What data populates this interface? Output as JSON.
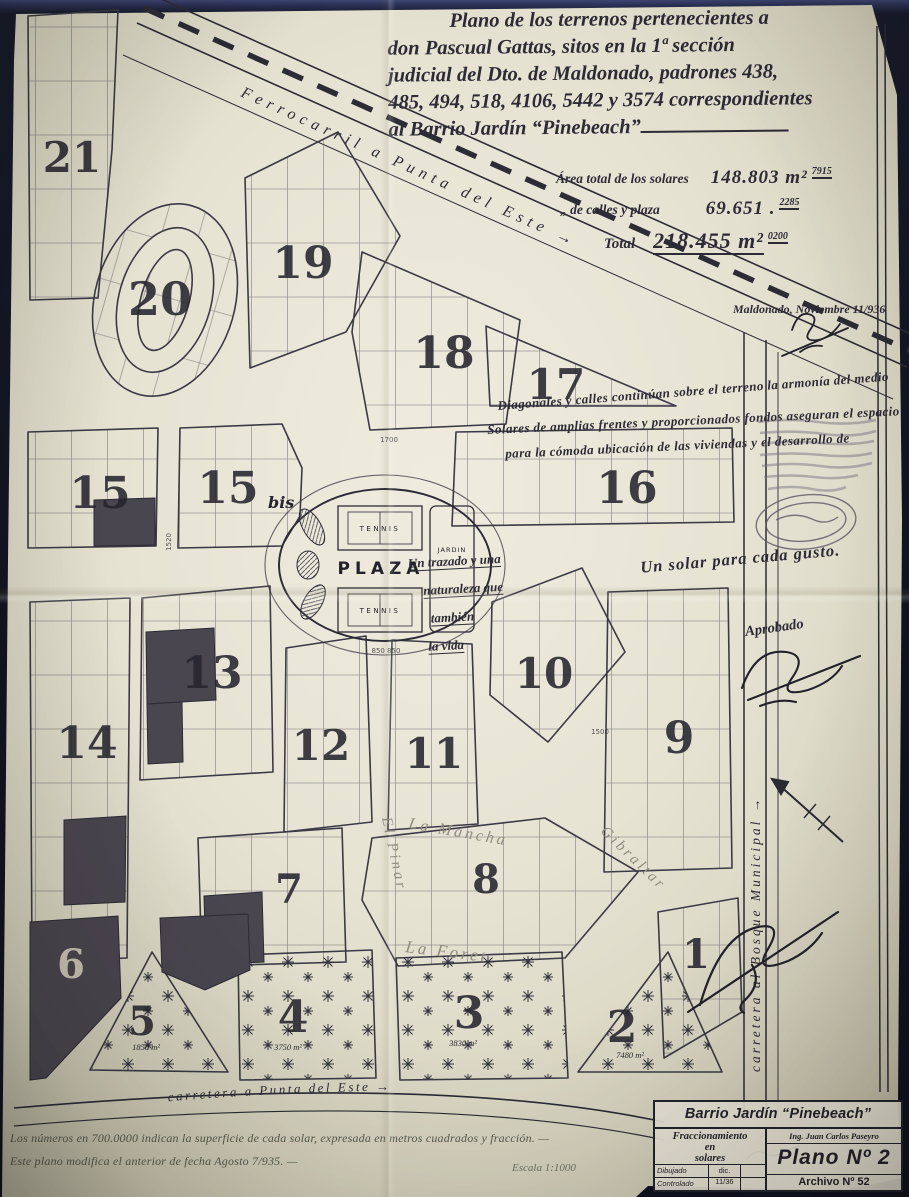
{
  "photo": {
    "paper_color": "#e9e5d6",
    "background_color": "#12141f",
    "ink_color": "#2c2b36",
    "pencil_color": "#8f8b7e"
  },
  "title": {
    "lines": [
      "Plano de los terrenos pertenecientes a",
      "don Pascual Gattas, sitos en la 1ª sección",
      "judicial del Dto. de Maldonado, padrones 438,",
      "485, 494, 518, 4106, 5442 y 3574 correspondientes",
      "al Barrio Jardín  “Pinebeach”"
    ]
  },
  "areas": {
    "row1_label": "Área total de los solares",
    "row1_value": "148.803 m²",
    "row1_sup": "7915",
    "row2_label": "„  de calles y plaza",
    "row2_value": "69.651 .",
    "row2_sup": "2285",
    "total_label": "Total",
    "total_value": "218.455 m²",
    "total_sup": "0200"
  },
  "annotations": {
    "date": "Maldonado, Noviembre 11/936",
    "slogan1": "Diagonales y calles continúan sobre el terreno la armonía del medio",
    "slogan2": "Solares de amplias frentes y proporcionados fondos aseguran el espacio",
    "slogan3": "para la cómoda ubicación de las viviendas y el desarrollo de",
    "plaza_note": [
      "Un trazado y una",
      "naturaleza que",
      "también",
      "la vida"
    ],
    "tagline": "Un solar para cada gusto.",
    "approved": "Aprobado",
    "note1": "Los números en 700.0000 indican la superficie de cada solar, expresada en metros cuadrados y fracción. —",
    "note2": "Este plano modifica el anterior de fecha Agosto 7/935. —",
    "scale": "Escala 1:1000"
  },
  "map": {
    "railway_label": "Ferrocarril a Punta del Este →",
    "road_bottom_label": "carretera a Punta del Este →",
    "road_right_label": "carretera al Bosque Municipal →",
    "plaza": {
      "label": "PLAZA",
      "tennis_top": "TENNIS",
      "tennis_bottom": "TENNIS",
      "garden": "JARDIN"
    },
    "bis": "bis",
    "blocks": [
      {
        "n": "21"
      },
      {
        "n": "20"
      },
      {
        "n": "19"
      },
      {
        "n": "18"
      },
      {
        "n": "17"
      },
      {
        "n": "16"
      },
      {
        "n": "15"
      },
      {
        "n": "15"
      },
      {
        "n": "14"
      },
      {
        "n": "13"
      },
      {
        "n": "12"
      },
      {
        "n": "11"
      },
      {
        "n": "10"
      },
      {
        "n": "9"
      },
      {
        "n": "8"
      },
      {
        "n": "7"
      },
      {
        "n": "6"
      },
      {
        "n": "5"
      },
      {
        "n": "4"
      },
      {
        "n": "3"
      },
      {
        "n": "2"
      },
      {
        "n": "1"
      }
    ],
    "tree_areas": [
      "1850 m²",
      "3750 m²",
      "3830 m²",
      "7480 m²"
    ],
    "street_names": [
      "El Pinar",
      "La Mancha",
      "Gibraltar",
      "La Foret"
    ],
    "dims": [
      "1700",
      "850  850",
      "1500",
      "1520"
    ]
  },
  "titleblock": {
    "name": "Barrio Jardín “Pinebeach”",
    "sub_lines": [
      "Fraccionamiento",
      "en",
      "solares"
    ],
    "engineer": "Ing. Juan Carlos Paseyro",
    "plan": "Plano Nº 2",
    "file": "Archivo Nº 52",
    "drawn_label": "Dibujado",
    "drawn_date": "dic. 11/36",
    "checked_label": "Controlado"
  }
}
